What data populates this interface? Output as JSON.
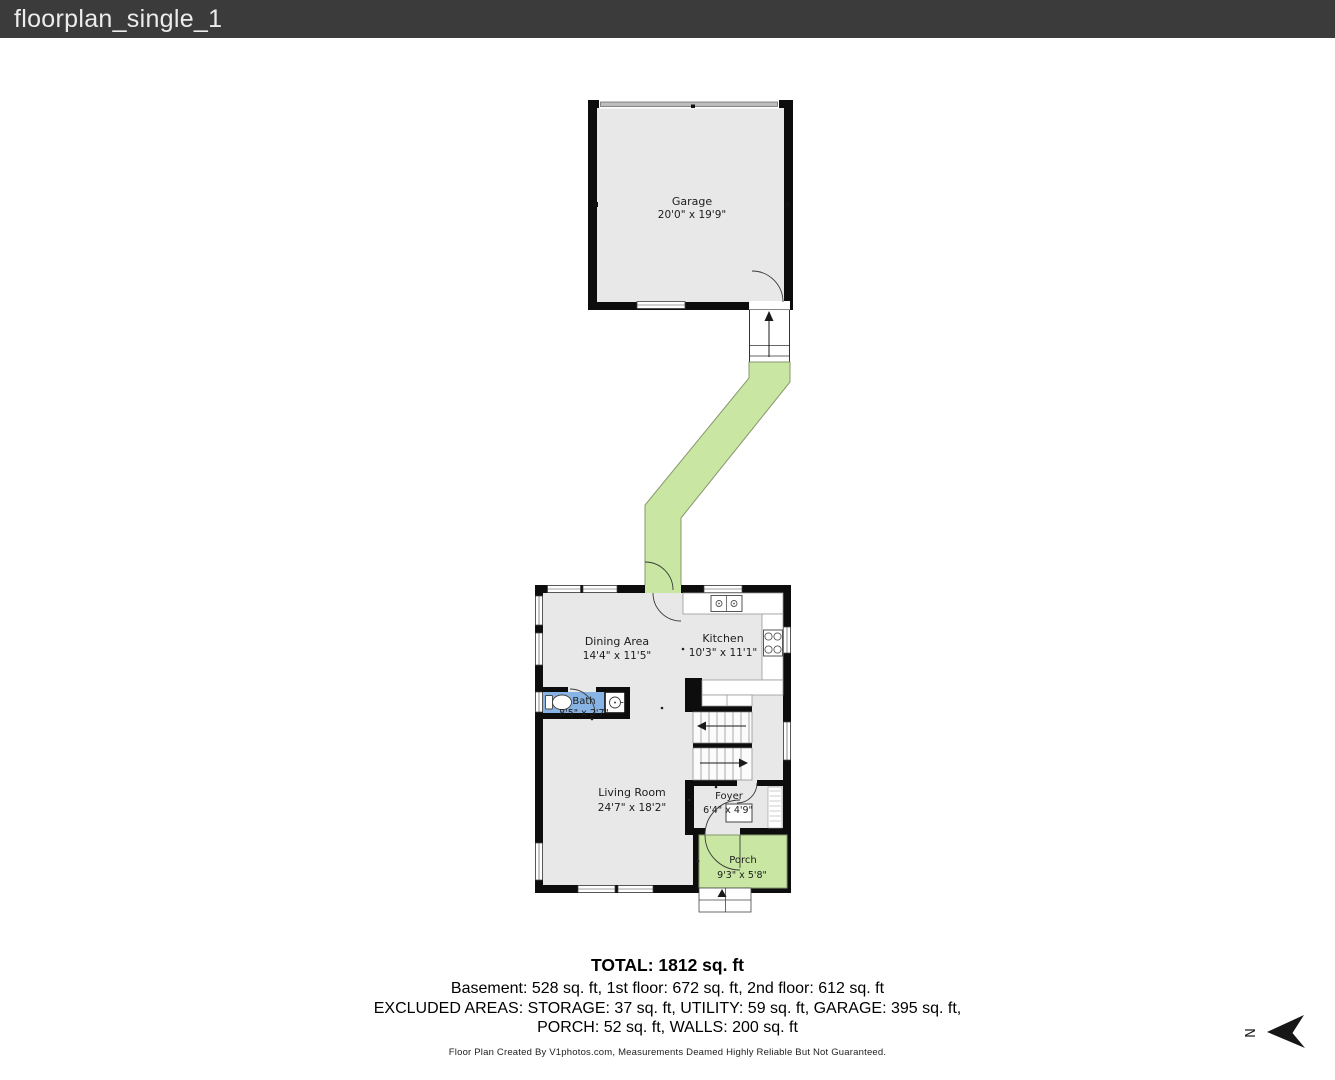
{
  "header": {
    "title": "floorplan_single_1"
  },
  "plan": {
    "rooms": {
      "garage": {
        "name": "Garage",
        "dims": "20'0\" x 19'9\""
      },
      "dining": {
        "name": "Dining Area",
        "dims": "14'4\" x 11'5\""
      },
      "kitchen": {
        "name": "Kitchen",
        "dims": "10'3\" x 11'1\""
      },
      "bath": {
        "name": "Bath",
        "dims": "8'5\" x 2'7\""
      },
      "living": {
        "name": "Living Room",
        "dims": "24'7\" x 18'2\""
      },
      "foyer": {
        "name": "Foyer",
        "dims": "6'4\" x 4'9\""
      },
      "porch": {
        "name": "Porch",
        "dims": "9'3\" x 5'8\""
      }
    },
    "compass": {
      "label": "N"
    },
    "colors": {
      "header_bg": "#3b3b3b",
      "wall": "#0d0d0d",
      "floor": "#e8e8e8",
      "walkway_green": "#c9e7a2",
      "bath_blue": "#87b4e4"
    }
  },
  "summary": {
    "total": "TOTAL: 1812 sq. ft",
    "floors": "Basement: 528 sq. ft, 1st floor: 672 sq. ft, 2nd floor: 612 sq. ft",
    "excluded1": "EXCLUDED AREAS: STORAGE: 37 sq. ft, UTILITY: 59 sq. ft, GARAGE: 395 sq. ft,",
    "excluded2": "PORCH: 52 sq. ft, WALLS: 200 sq. ft",
    "credit": "Floor Plan Created By V1photos.com, Measurements Deamed Highly Reliable But Not Guaranteed."
  }
}
